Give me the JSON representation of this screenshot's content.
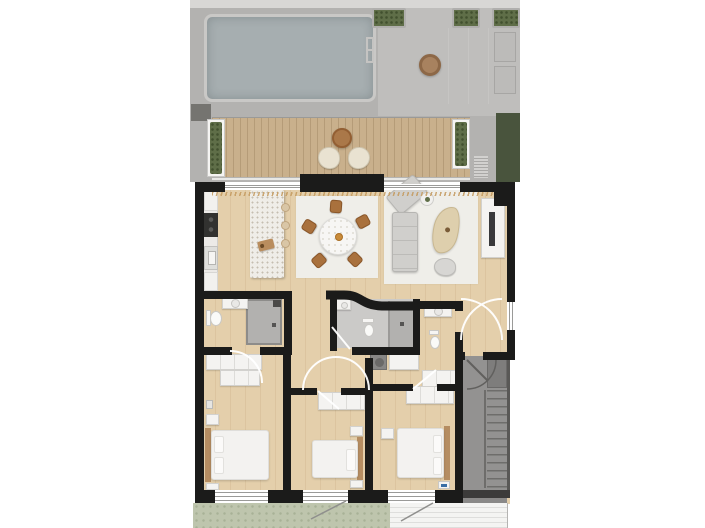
{
  "page": {
    "width": 705,
    "height": 528,
    "background": "#ffffff"
  },
  "palette": {
    "white": "#ffffff",
    "wall": "#1b1b1a",
    "wood": "#e4cfab",
    "woodGrain": "rgba(146,104,52,0.10)",
    "terrace": "#b3b2b0",
    "terraceLight": "#bfbebc",
    "topBand": "#d8d7d5",
    "pool": "#a6aeb0",
    "poolEdge": "#c9c8c6",
    "deck": "#c9b08c",
    "deckPlank": "rgba(90,62,30,0.18)",
    "plant": "#5f6e48",
    "planterFrame": "#f5f4f2",
    "hedge": "#49543d",
    "garden": "#bec5ad",
    "stair": "#939291",
    "stairDark": "#6e6d6b",
    "bathFloor": "#cbcac8",
    "shower": "#b2b1af",
    "furn": "#f4f3f1",
    "furnEdge": "#d2d1ce",
    "sofa": "#d0cfcc",
    "sofaEdge": "#b6b5b2",
    "chaise": "#decfad",
    "chaiseEdge": "#c8b790",
    "chairWood": "#a9713d",
    "chairWoodEdge": "#8a5628",
    "rug": "#efeee9",
    "tableWood": "#aa7849",
    "headboard": "#b58d62",
    "cooktop": "#323230",
    "tv": "#39393b",
    "stripeA": "#f4f4f2",
    "stripeB": "#dededc",
    "trim": "#c49a5e",
    "mark": "#3a6ea5",
    "arc": "#ffffff"
  },
  "floorplan": {
    "view": "top-down-3d-render",
    "outdoor_top": [
      "roof-terrace",
      "swimming-pool",
      "pool-ladder",
      "round-planter",
      "planter-boxes"
    ],
    "balcony": [
      "wood-deck",
      "planter-left",
      "planter-right",
      "bistro-table",
      "lounge-chair-left",
      "lounge-chair-right",
      "balustrade",
      "hedge"
    ],
    "living_area": [
      "kitchen-counter",
      "cooktop",
      "kitchen-sink",
      "kitchen-island",
      "cutting-board",
      "bar-stools",
      "dining-rug",
      "dining-table",
      "dining-chairs",
      "living-rug",
      "sectional-sofa",
      "sofa-side-table",
      "chaise-lounge",
      "pouf",
      "tv-console",
      "tv",
      "window-trim"
    ],
    "bathrooms": [
      "bathroom-left",
      "shower-left",
      "vanity-left",
      "toilet-left",
      "bathroom-middle-curved-wall",
      "shower-middle",
      "vanity-middle",
      "toilet-middle",
      "bathroom-right",
      "vanity-right",
      "toilet-right",
      "laundry-appliance"
    ],
    "bedrooms": [
      "bedroom-left",
      "bedroom-middle",
      "bedroom-right",
      "beds",
      "wardrobes",
      "nightstands"
    ],
    "circulation": [
      "hallway",
      "door-swing-arcs",
      "entrance-hall",
      "stairwell",
      "staircase",
      "hall-cabinets"
    ],
    "outdoor_bottom": [
      "garden-strip",
      "paved-terrace"
    ]
  }
}
